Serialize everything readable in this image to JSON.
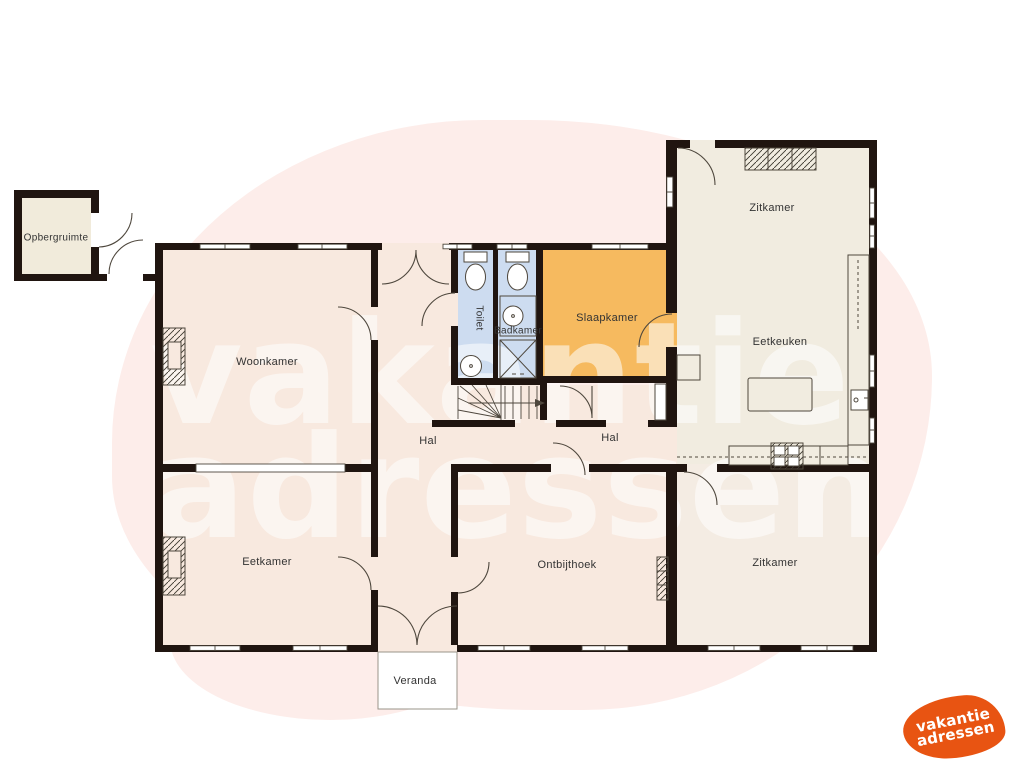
{
  "watermark": {
    "line1": "vakantie",
    "line2": "adressen"
  },
  "logo": {
    "line1": "vakantie",
    "line2": "adressen"
  },
  "rooms": {
    "opbergruimte": {
      "label": "Opbergruimte"
    },
    "woonkamer": {
      "label": "Woonkamer"
    },
    "toilet": {
      "label": "Toilet"
    },
    "badkamer": {
      "label": "Badkamer"
    },
    "slaapkamer": {
      "label": "Slaapkamer"
    },
    "zitkamer_boven": {
      "label": "Zitkamer"
    },
    "eetkeuken": {
      "label": "Eetkeuken"
    },
    "hal_links": {
      "label": "Hal"
    },
    "hal_rechts": {
      "label": "Hal"
    },
    "eetkamer": {
      "label": "Eetkamer"
    },
    "ontbijthoek": {
      "label": "Ontbijthoek"
    },
    "zitkamer_beneden": {
      "label": "Zitkamer"
    },
    "veranda": {
      "label": "Veranda"
    }
  },
  "colors": {
    "wall": "#201510",
    "line": "#4e473d",
    "floor_main": "#f8e9df",
    "floor_right": "#f1ece0",
    "floor_right_lower": "#f4ece3",
    "floor_wet": "#cddcf0",
    "floor_bedroom": "#f6ba5f",
    "floor_storage": "#f1ebdb",
    "blob": "#fdedea",
    "logo_orange": "#e85412",
    "label": "#333333"
  }
}
